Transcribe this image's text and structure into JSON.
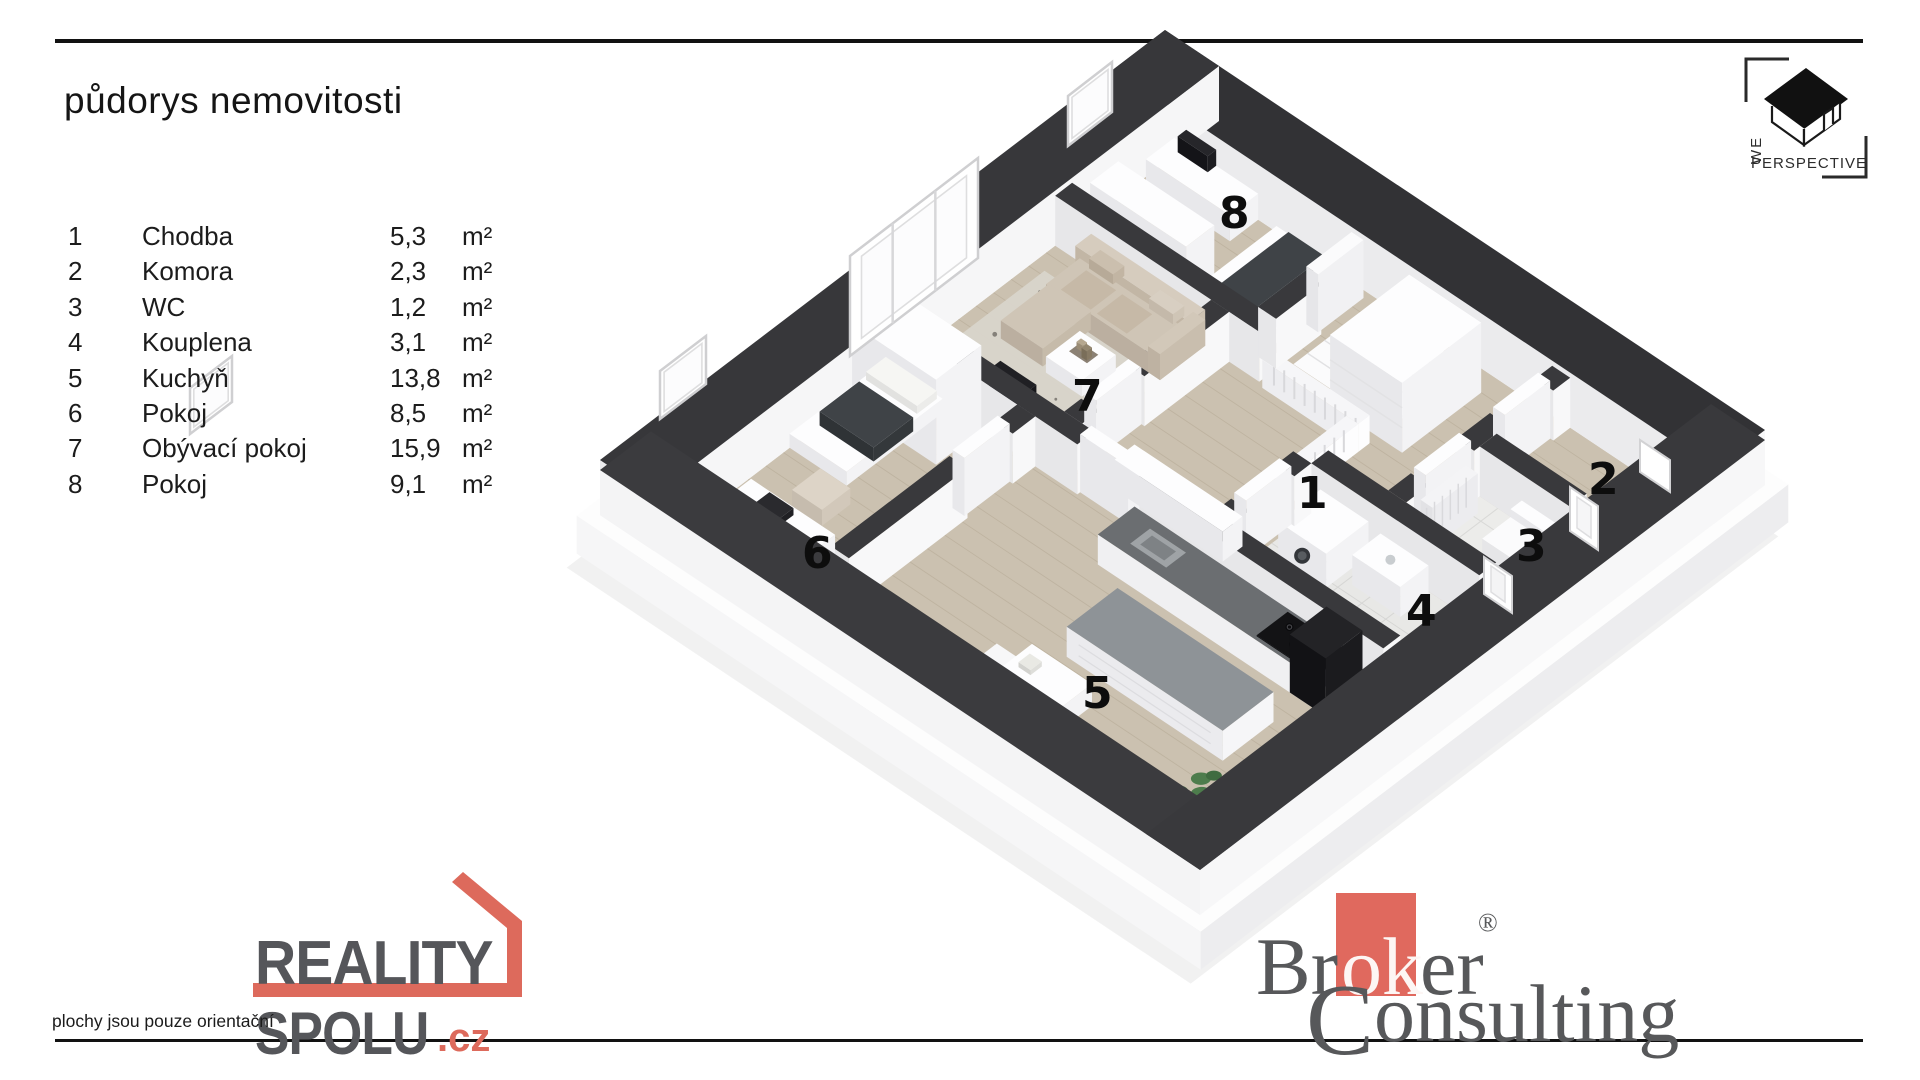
{
  "header": {
    "title": "půdorys nemovitosti"
  },
  "legend": {
    "unit": "m²",
    "rows": [
      {
        "num": "1",
        "name": "Chodba",
        "area": "5,3",
        "unit": "m²"
      },
      {
        "num": "2",
        "name": "Komora",
        "area": "2,3",
        "unit": "m²"
      },
      {
        "num": "3",
        "name": "WC",
        "area": "1,2",
        "unit": "m²"
      },
      {
        "num": "4",
        "name": "Kouplena",
        "area": "3,1",
        "unit": "m²"
      },
      {
        "num": "5",
        "name": "Kuchyň",
        "area": "13,8",
        "unit": "m²"
      },
      {
        "num": "6",
        "name": "Pokoj",
        "area": "8,5",
        "unit": "m²"
      },
      {
        "num": "7",
        "name": "Obývací pokoj",
        "area": "15,9",
        "unit": "m²"
      },
      {
        "num": "8",
        "name": "Pokoj",
        "area": "9,1",
        "unit": "m²"
      }
    ]
  },
  "floorplan": {
    "room_labels": {
      "r1": "1",
      "r2": "2",
      "r3": "3",
      "r4": "4",
      "r5": "5",
      "r6": "6",
      "r7": "7",
      "r8": "8"
    }
  },
  "watermark_we": {
    "we": "WE",
    "perspective": "PERSPECTIVE"
  },
  "logo_reality": {
    "line1": "REALITY",
    "line2": "SPOLU",
    "tld": ".cz",
    "accent": "#dd6a5c",
    "gray": "#55565a"
  },
  "logo_broker": {
    "p1": "Br",
    "p2": "ok",
    "p3": "er",
    "reg": "®",
    "line2_initial": "C",
    "line2_rest": "onsulting",
    "accent": "#e0695e",
    "gray": "#57585a"
  },
  "footer": {
    "disclaimer": "plochy jsou pouze orientační"
  }
}
